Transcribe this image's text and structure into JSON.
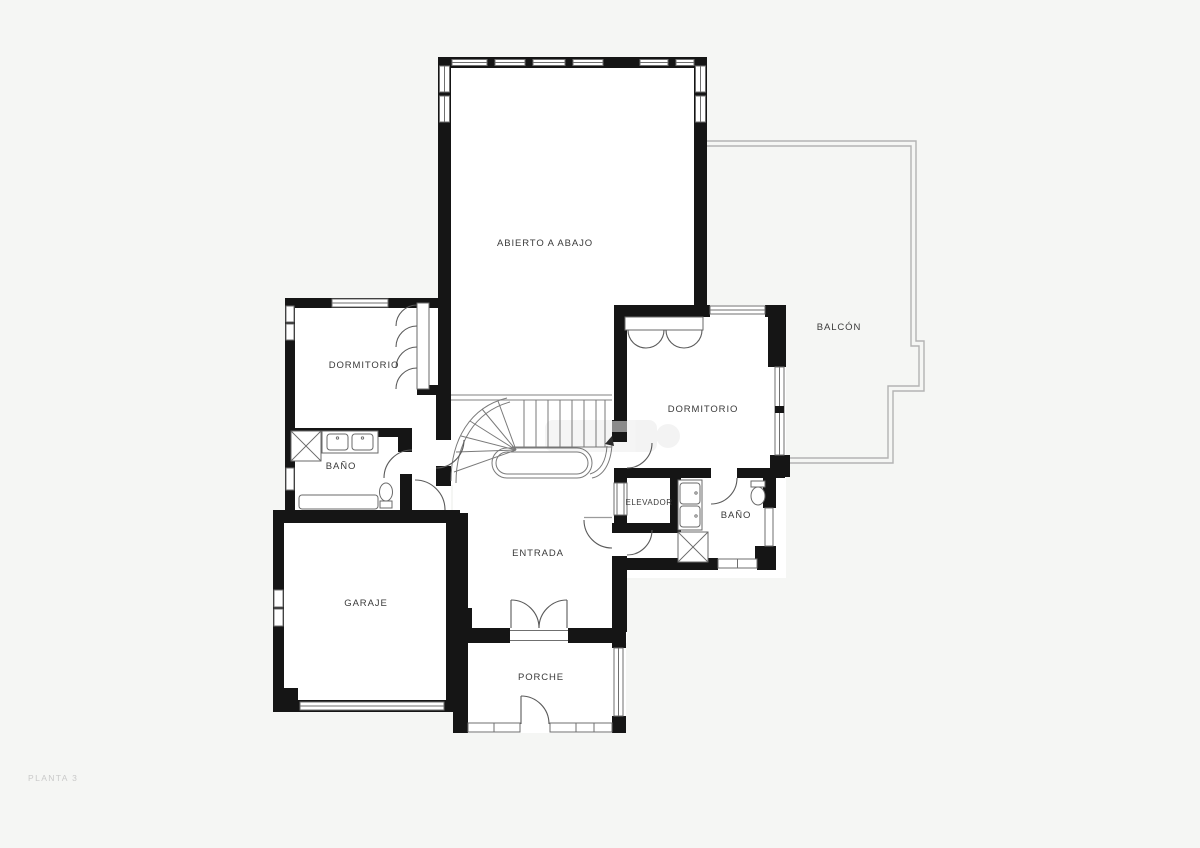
{
  "plan": {
    "floor_label": "PLANTA 3",
    "rooms": [
      {
        "id": "abierto-a-abajo",
        "label": "ABIERTO A ABAJO"
      },
      {
        "id": "balcon",
        "label": "BALCÓN"
      },
      {
        "id": "dormitorio-1",
        "label": "DORMITORIO"
      },
      {
        "id": "dormitorio-2",
        "label": "DORMITORIO"
      },
      {
        "id": "bano-1",
        "label": "BAÑO"
      },
      {
        "id": "elevador",
        "label": "ELEVADOR"
      },
      {
        "id": "bano-2",
        "label": "BAÑO"
      },
      {
        "id": "entrada",
        "label": "ENTRADA"
      },
      {
        "id": "garaje",
        "label": "GARAJE"
      },
      {
        "id": "porche",
        "label": "PORCHE"
      }
    ],
    "colors": {
      "wall": "#151515",
      "line": "#6f6f6f",
      "thin": "#9b9b9b",
      "balcony": "#b3b3b3",
      "background": "#f5f6f4",
      "room": "#ffffff",
      "label": "#3a3a3a",
      "floor_label": "#c9c9c9"
    }
  }
}
